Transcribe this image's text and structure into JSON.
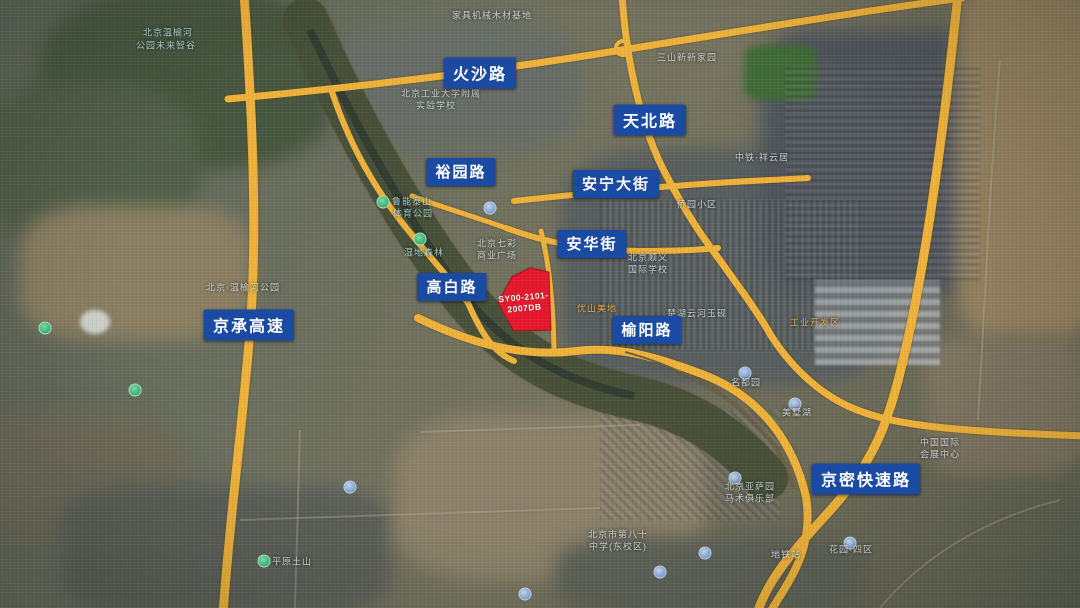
{
  "map": {
    "description": "satellite-road-map",
    "colors": {
      "road": "#eeb23a",
      "label_bg": "#1b4aa2",
      "label_text": "#ffffff",
      "site_fill": "#e5182b"
    },
    "site": {
      "code_line1": "SY00-2101-",
      "code_line2": "2007DB"
    },
    "road_labels": [
      {
        "id": "huosha",
        "text": "火沙路",
        "x": 480,
        "y": 73,
        "size": 16
      },
      {
        "id": "tianbei",
        "text": "天北路",
        "x": 650,
        "y": 120,
        "size": 16
      },
      {
        "id": "yuyuan",
        "text": "裕园路",
        "x": 461,
        "y": 172,
        "size": 15
      },
      {
        "id": "anning",
        "text": "安宁大街",
        "x": 616,
        "y": 184,
        "size": 15
      },
      {
        "id": "anhua",
        "text": "安华街",
        "x": 592,
        "y": 244,
        "size": 15
      },
      {
        "id": "gaobai",
        "text": "高白路",
        "x": 452,
        "y": 287,
        "size": 15
      },
      {
        "id": "jingcheng",
        "text": "京承高速",
        "x": 249,
        "y": 325,
        "size": 16
      },
      {
        "id": "yuyang",
        "text": "榆阳路",
        "x": 647,
        "y": 330,
        "size": 15
      },
      {
        "id": "jingmi",
        "text": "京密快速路",
        "x": 866,
        "y": 479,
        "size": 16
      }
    ],
    "bg_labels": [
      {
        "text": "北京温榆河",
        "x": 168,
        "y": 32,
        "c": "cyan"
      },
      {
        "text": "公园未来智谷",
        "x": 166,
        "y": 45,
        "c": "cyan"
      },
      {
        "text": "家具机械木材基地",
        "x": 492,
        "y": 15,
        "c": "white"
      },
      {
        "text": "三山新新家园",
        "x": 687,
        "y": 57,
        "c": "white"
      },
      {
        "text": "北京工业大学附属",
        "x": 441,
        "y": 93,
        "c": "white"
      },
      {
        "text": "实验学校",
        "x": 436,
        "y": 105,
        "c": "white"
      },
      {
        "text": "中铁·祥云居",
        "x": 762,
        "y": 157,
        "c": "white"
      },
      {
        "text": "侨园小区",
        "x": 697,
        "y": 204,
        "c": "white"
      },
      {
        "text": "鲁能泰山",
        "x": 412,
        "y": 201,
        "c": "cyan"
      },
      {
        "text": "体育公园",
        "x": 413,
        "y": 213,
        "c": "cyan"
      },
      {
        "text": "湿地森林",
        "x": 424,
        "y": 252,
        "c": "cyan"
      },
      {
        "text": "北京·温榆河公园",
        "x": 243,
        "y": 287,
        "c": "white"
      },
      {
        "text": "北京七彩",
        "x": 497,
        "y": 243,
        "c": "white"
      },
      {
        "text": "商业广场",
        "x": 497,
        "y": 255,
        "c": "white"
      },
      {
        "text": "北京顺义",
        "x": 648,
        "y": 257,
        "c": "white"
      },
      {
        "text": "国际学校",
        "x": 648,
        "y": 269,
        "c": "white"
      },
      {
        "text": "优山美地",
        "x": 597,
        "y": 308,
        "c": "orange"
      },
      {
        "text": "楚湖云河玉砚",
        "x": 697,
        "y": 313,
        "c": "white"
      },
      {
        "text": "工业开发区",
        "x": 815,
        "y": 322,
        "c": "orange"
      },
      {
        "text": "名都园",
        "x": 746,
        "y": 382,
        "c": "white"
      },
      {
        "text": "美墅湖",
        "x": 797,
        "y": 412,
        "c": "white"
      },
      {
        "text": "中国国际",
        "x": 940,
        "y": 442,
        "c": "white"
      },
      {
        "text": "会展中心",
        "x": 940,
        "y": 454,
        "c": "white"
      },
      {
        "text": "北京亚萨园",
        "x": 750,
        "y": 486,
        "c": "white"
      },
      {
        "text": "马术俱乐部",
        "x": 750,
        "y": 498,
        "c": "white"
      },
      {
        "text": "北京市第八十",
        "x": 618,
        "y": 534,
        "c": "white"
      },
      {
        "text": "中学(东校区)",
        "x": 618,
        "y": 546,
        "c": "white"
      },
      {
        "text": "平原土山",
        "x": 292,
        "y": 561,
        "c": "white"
      },
      {
        "text": "花园·四区",
        "x": 851,
        "y": 549,
        "c": "white"
      },
      {
        "text": "地铁站",
        "x": 786,
        "y": 554,
        "c": "white"
      }
    ]
  }
}
